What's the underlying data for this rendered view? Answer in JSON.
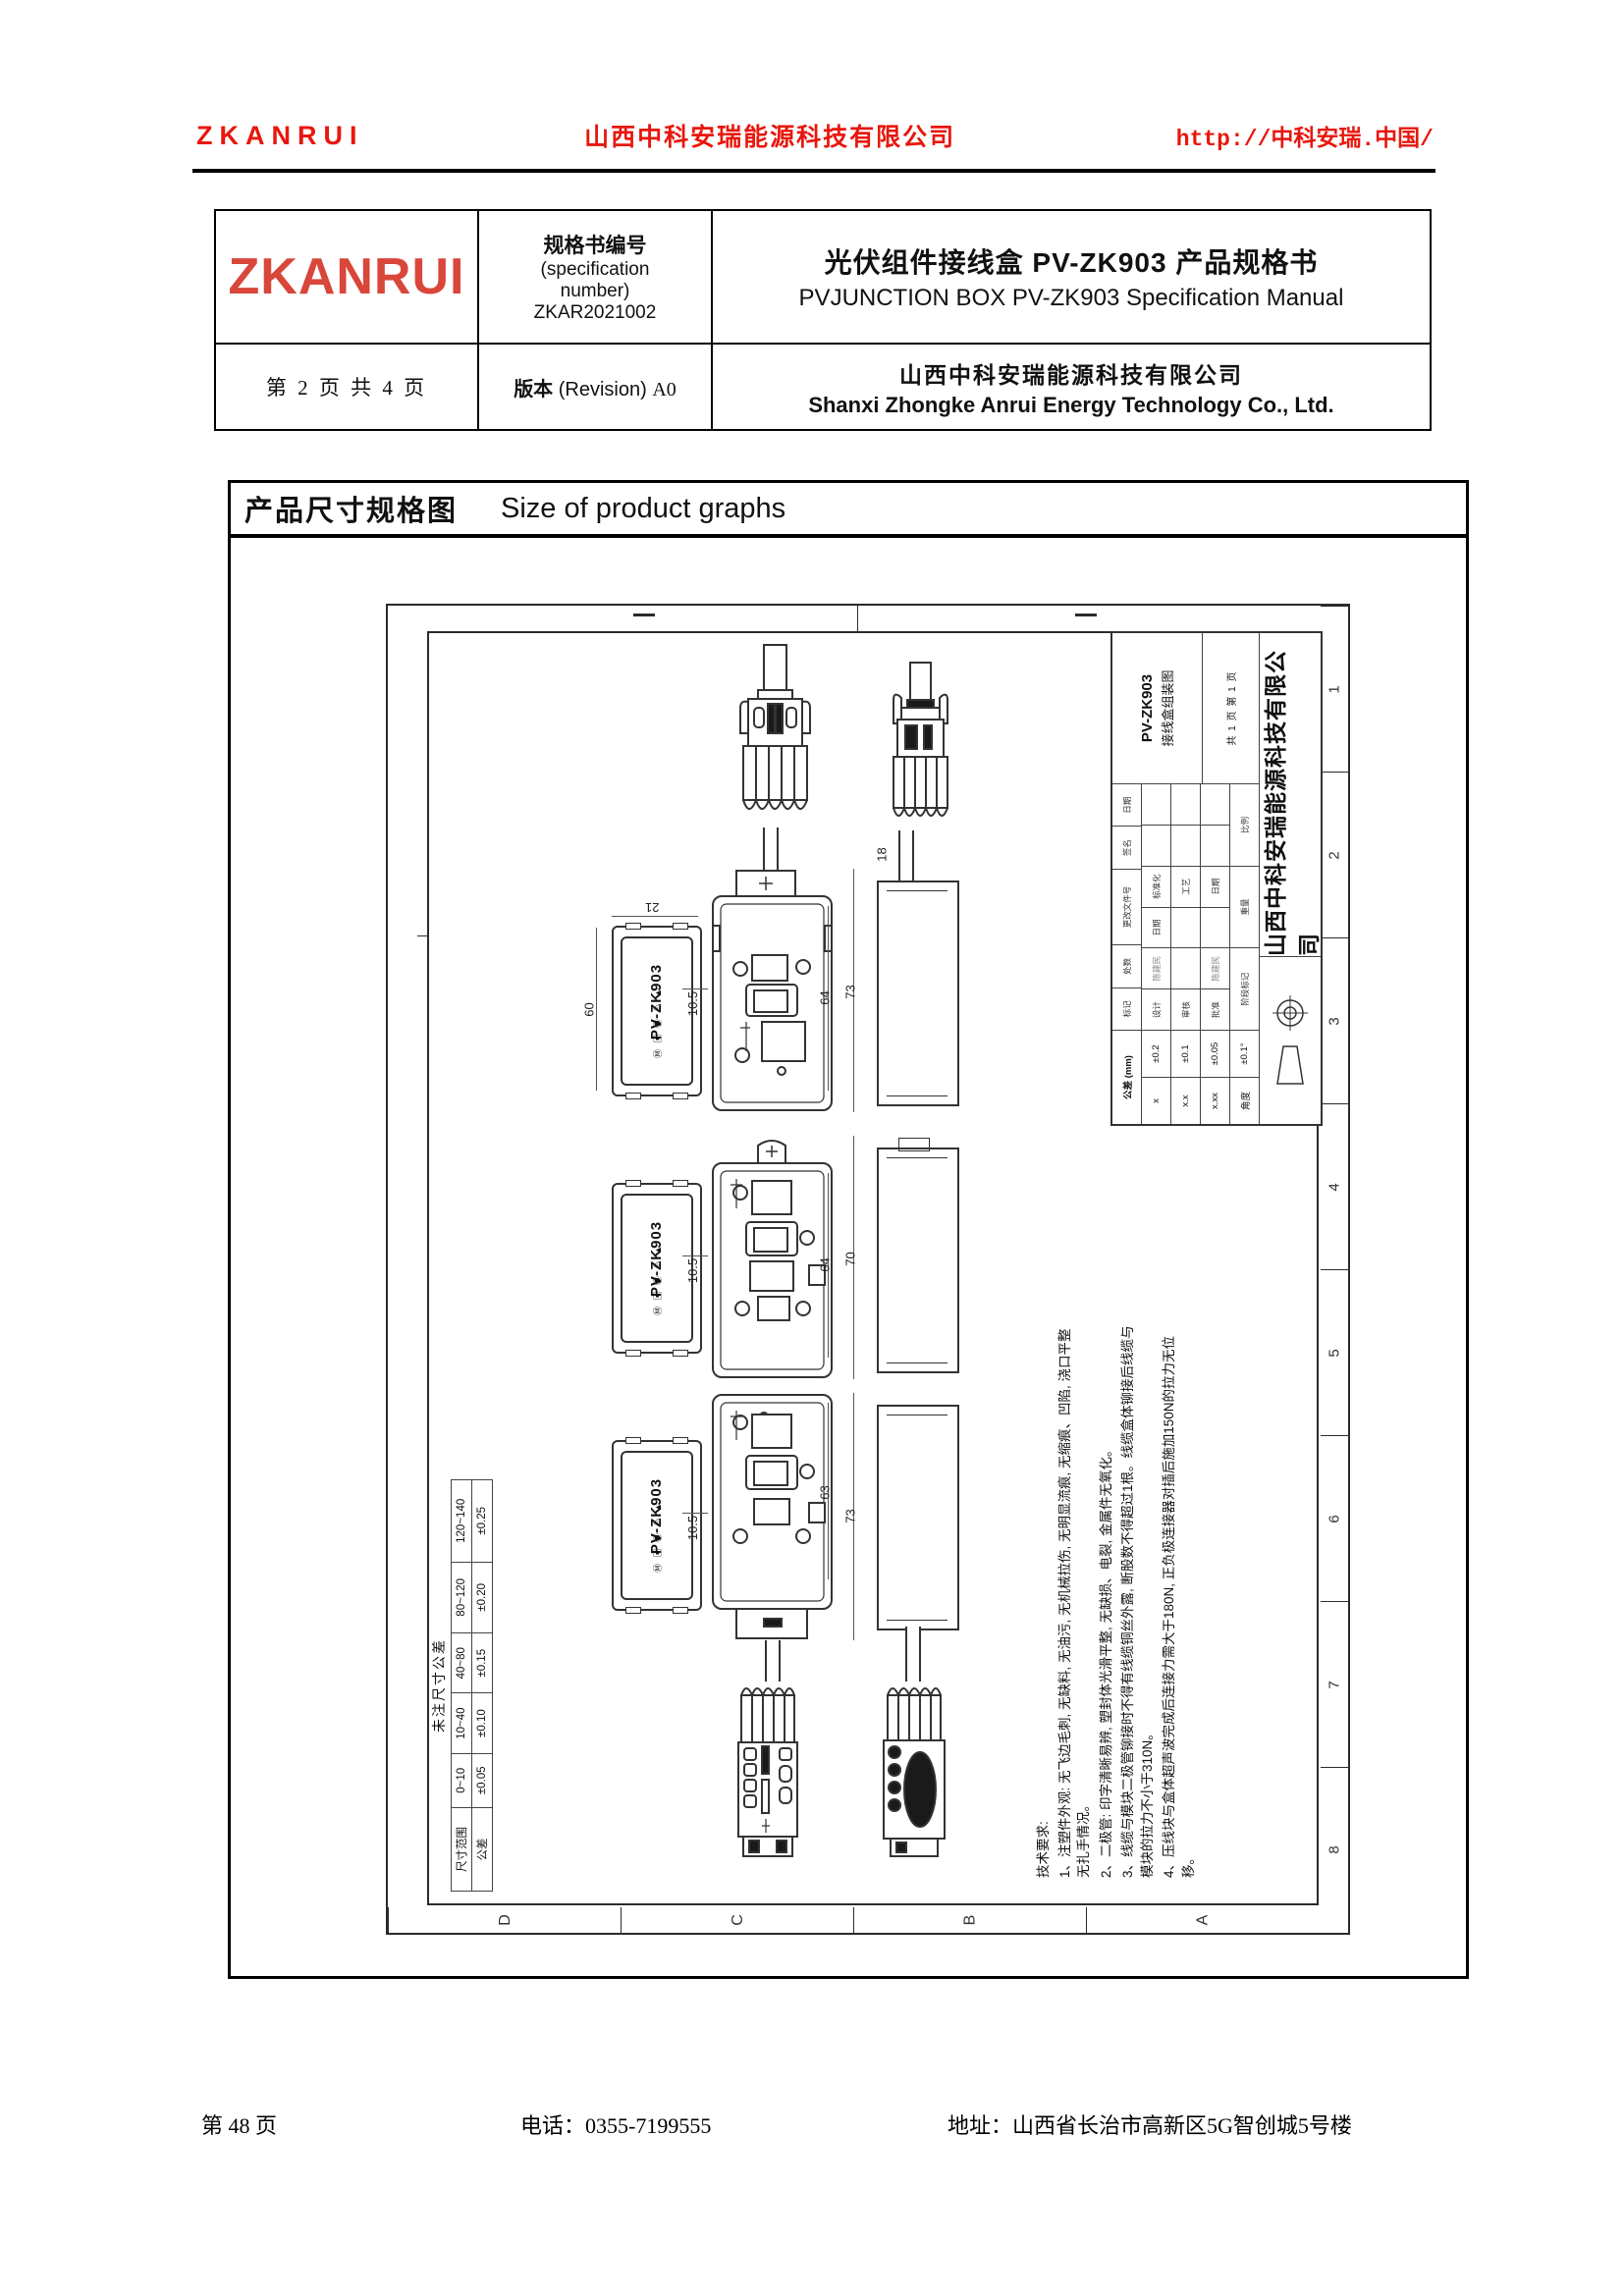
{
  "theme": {
    "accent_red": "#e8170d",
    "logo_red": "#d9463a",
    "line_color": "#333333"
  },
  "header": {
    "brand": "ZKANRUI",
    "company_cn": "山西中科安瑞能源科技有限公司",
    "url": "http://中科安瑞.中国/"
  },
  "spec_table": {
    "logo": "ZKANRUI",
    "spec_no_label_cn": "规格书编号",
    "spec_no_label_en1": "(specification",
    "spec_no_label_en2": "number)",
    "spec_no_value": "ZKAR2021002",
    "title_cn": "光伏组件接线盒 PV-ZK903 产品规格书",
    "title_en": "PVJUNCTION BOX PV-ZK903 Specification Manual",
    "page_info": "第 2 页 共 4 页",
    "revision_label_cn": "版本",
    "revision_label_en": "(Revision)",
    "revision_value": "A0",
    "company_cn": "山西中科安瑞能源科技有限公司",
    "company_en": "Shanxi Zhongke Anrui Energy Technology Co., Ltd."
  },
  "section": {
    "title_cn": "产品尺寸规格图",
    "title_en": "Size of product graphs"
  },
  "drawing": {
    "border_numbers": [
      "1",
      "2",
      "3",
      "4",
      "5",
      "6",
      "7",
      "8"
    ],
    "border_letters": [
      "D",
      "C",
      "B",
      "A"
    ],
    "product_label": "PV-ZK903",
    "label_cert_icons": "Ⓜ ▣ ◉ ⚠ ▲",
    "dim_18": "18",
    "rows": [
      {
        "dims": {
          "w": "21",
          "h": "60",
          "offset": "10.5",
          "inner": "64",
          "total": "73"
        }
      },
      {
        "dims": {
          "offset": "10.5",
          "inner": "64",
          "total": "70"
        }
      },
      {
        "dims": {
          "offset": "10.5",
          "inner": "63",
          "total": "73"
        }
      }
    ],
    "tol_table": {
      "title": "未注尺寸公差",
      "row1": [
        "尺寸范围",
        "0~10",
        "10~40",
        "40~80",
        "80~120",
        "120~140"
      ],
      "row2": [
        "公差",
        "±0.05",
        "±0.10",
        "±0.15",
        "±0.20",
        "±0.25"
      ]
    },
    "tech_notes": {
      "title": "技术要求:",
      "items": [
        "1、注塑件外观: 无飞边毛刺, 无缺料, 无油污, 无机械拉伤, 无明显流痕, 无缩痕、凹陷, 浇口平整无扎手情况。",
        "2、二极管: 印字清晰易辨, 塑封体光滑平整, 无缺损、电裂, 金属件无氧化。",
        "3、线缆与模块二极管铆接时不得有线缆铜丝外露, 断股数不得超过1根。线缆盒体铆接后线缆与模块的拉力不小于310N。",
        "4、压线块与盒体超声波完成后连接力需大于180N, 正负极连接器对插后施加150N的拉力无位移。"
      ]
    },
    "title_block": {
      "company": "山西中科安瑞能源科技有限公司",
      "product": "PV-ZK903",
      "drawing_name": "接线盒组装图",
      "tol_title": "公差 (mm)",
      "tol_rows": [
        [
          "x",
          "±0.2"
        ],
        [
          "x.x",
          "±0.1"
        ],
        [
          "x.xx",
          "±0.05"
        ],
        [
          "角度",
          "±0.1°"
        ]
      ],
      "rev_row": [
        "标记",
        "处数",
        "更改文件号",
        "签名",
        "日期"
      ],
      "sig_row1": [
        "设计",
        "陈建民",
        "日期",
        "标准化",
        "",
        ""
      ],
      "sig_row2": [
        "审核",
        "",
        "",
        "工艺",
        "",
        ""
      ],
      "sig_row3": [
        "批准",
        "陈建民",
        "",
        "日期",
        "",
        ""
      ],
      "stage_row": [
        "阶段标记",
        "重量",
        "比例"
      ],
      "sheet_info": "共 1 页   第 1 页"
    }
  },
  "footer": {
    "page": "第 48 页",
    "phone": "电话：0355-7199555",
    "address": "地址：山西省长治市高新区5G智创城5号楼"
  }
}
